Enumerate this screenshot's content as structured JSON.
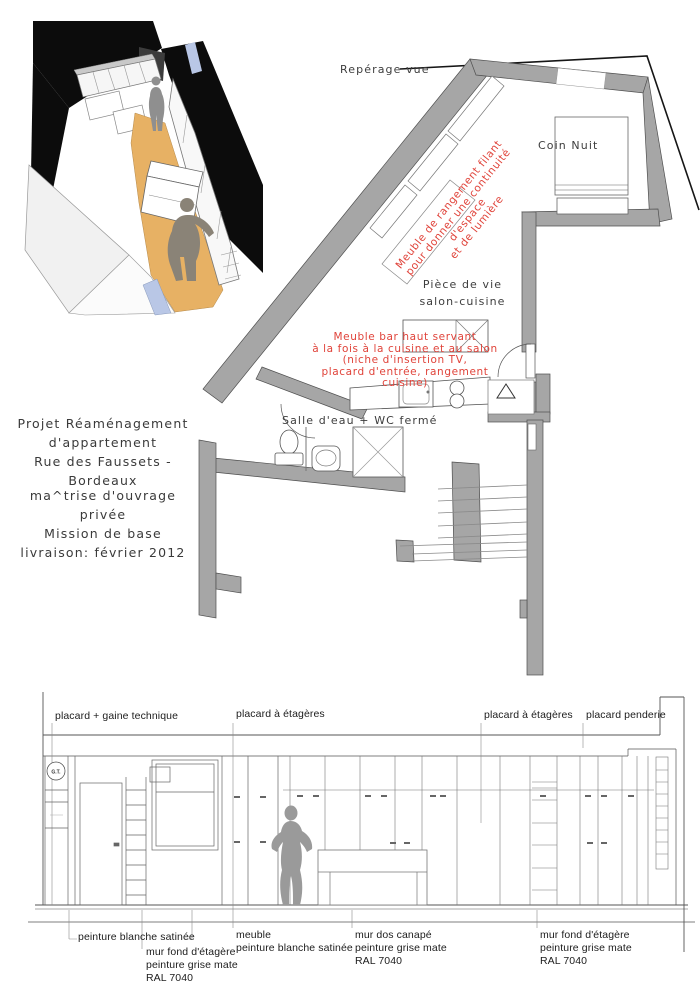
{
  "project": {
    "title_block": "Projet Réaménagement\nd'appartement\nRue des Faussets - Bordeaux",
    "details_block": "ma^trise d'ouvrage privée\nMission de base\nlivraison: février 2012"
  },
  "plan": {
    "view_marker_label": "Repérage vue",
    "room_labels": {
      "coin_nuit": "Coin Nuit",
      "piece_de_vie": "Pièce de vie\nsalon-cuisine",
      "salle_eau": "Salle d'eau + WC fermé"
    },
    "red_annotations": {
      "meuble_rangement": "Meuble de rangement filant\npour donner une continuité d'espace\net de lumière",
      "meuble_bar": "Meuble bar haut servant\nà la fois à la cuisine et au salon\n(niche d'insertion TV,\nplacard d'entrée, rangement cuisine)"
    },
    "annotation_color": "#e0433a",
    "wall_color": "#a6a6a6"
  },
  "elevation": {
    "top_labels": [
      "placard + gaine technique",
      "placard à étagères",
      "placard à étagères",
      "placard penderie"
    ],
    "gt_marker": "G.T.",
    "bottom_labels": [
      "peinture blanche satinée",
      "mur fond d'étagère\npeinture grise mate\nRAL 7040",
      "meuble\npeinture blanche satinée",
      "mur dos canapé\npeinture grise mate\nRAL 7040",
      "mur fond d'étagère\npeinture grise mate\nRAL 7040"
    ]
  },
  "axon": {
    "floor_color": "#e7b164",
    "silhouette_color": "#8f8f8f"
  }
}
